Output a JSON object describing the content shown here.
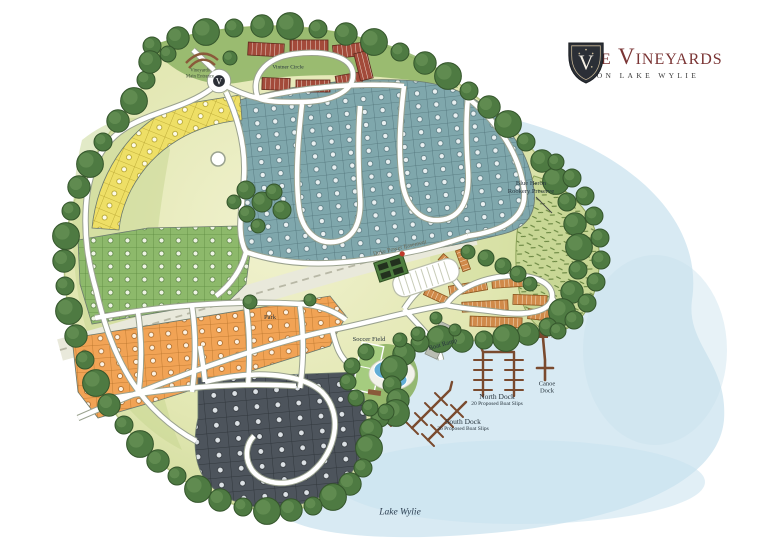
{
  "logo": {
    "monogram": "V",
    "title": "The Vineyards",
    "subtitle": "On Lake Wylie"
  },
  "labels": {
    "vintner_circle": "Vintner Circle",
    "duke_power_easement": "Duke Power Easement",
    "park": "Park",
    "soccer_field": "Soccer Field",
    "boat_ramp": "Boat Ramp",
    "north_dock_name": "North Dock",
    "north_dock_note": "20 Proposed Boat Slips",
    "south_dock_name": "South Dock",
    "south_dock_note": "26 Proposed Boat Slips",
    "canoe_dock": "Canoe Dock",
    "preserve_line1": "Blue Heron",
    "preserve_line2": "Rookery Preserve",
    "entrance_line1": "Vineyards",
    "entrance_line2": "Main Entrance",
    "lake": "Lake Wylie"
  },
  "colors": {
    "page-bg": "#ffffff",
    "water": "#d8eaf3",
    "water-deep": "#c9e2ee",
    "ground": "#e9ebc0",
    "ground-edge": "#c6d68f",
    "grass": "#8db364",
    "tree": "#4e7a42",
    "tree-dark": "#35562c",
    "tree-light": "#6a9557",
    "road": "#ffffff",
    "road-casing": "#9aa28f",
    "easement": "#e9e9db",
    "lot-teal": "#7fa7ac",
    "lot-yellow": "#eedf66",
    "lot-green": "#8db96b",
    "lot-orange": "#f1a355",
    "lot-charcoal": "#4d545c",
    "townhome-red": "#a34a3a",
    "townhome-tan": "#d08a4a",
    "preserve": "#c8d795",
    "dock": "#7a4a2e",
    "pool": "#62aed6",
    "logo-maroon": "#7a3434",
    "logo-shield": "#2b2f36",
    "label-ink": "#27343d"
  }
}
